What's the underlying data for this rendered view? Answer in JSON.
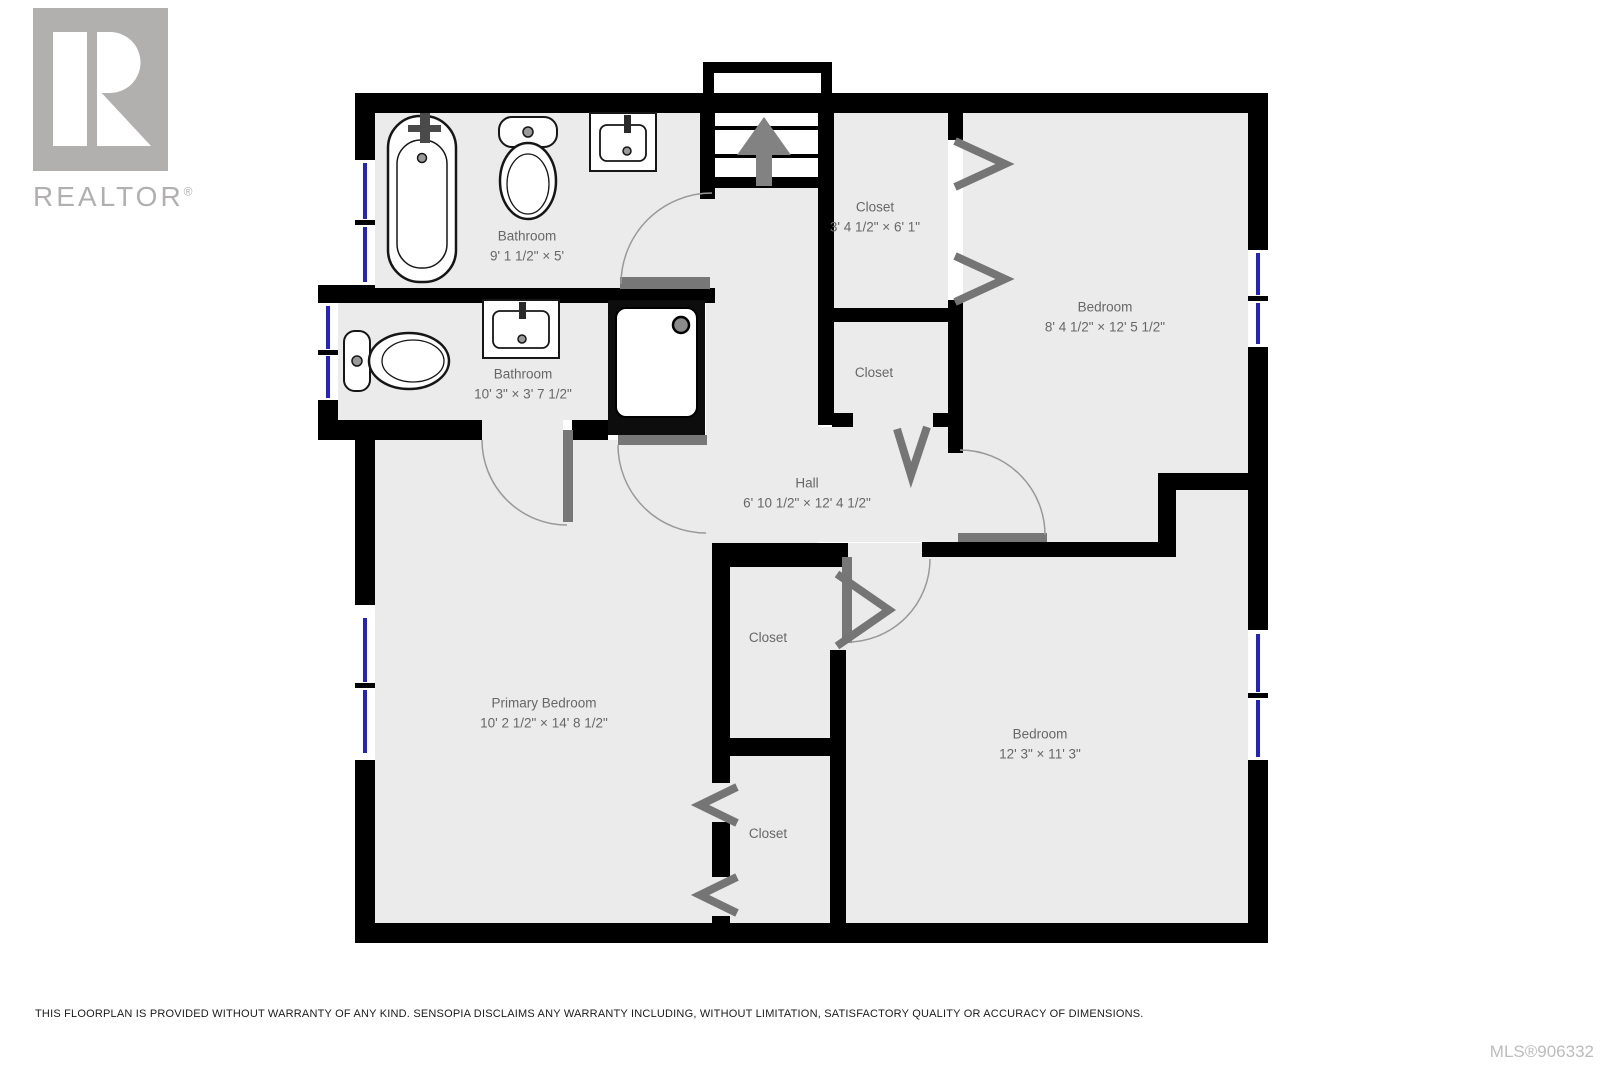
{
  "branding": {
    "logo_text": "REALTOR",
    "registered_mark": "®"
  },
  "rooms": [
    {
      "id": "bathroom-1",
      "name": "Bathroom",
      "dims": "9' 1 1/2\" × 5'"
    },
    {
      "id": "bathroom-2",
      "name": "Bathroom",
      "dims": "10' 3\" × 3' 7 1/2\""
    },
    {
      "id": "closet-1",
      "name": "Closet",
      "dims": "3' 4 1/2\" × 6' 1\""
    },
    {
      "id": "bedroom-1",
      "name": "Bedroom",
      "dims": "8' 4 1/2\" × 12' 5 1/2\""
    },
    {
      "id": "closet-2",
      "name": "Closet",
      "dims": ""
    },
    {
      "id": "hall",
      "name": "Hall",
      "dims": "6' 10 1/2\" × 12' 4 1/2\""
    },
    {
      "id": "primary-bedroom",
      "name": "Primary Bedroom",
      "dims": "10' 2 1/2\" × 14' 8 1/2\""
    },
    {
      "id": "closet-3",
      "name": "Closet",
      "dims": ""
    },
    {
      "id": "bedroom-2",
      "name": "Bedroom",
      "dims": "12' 3\" × 11' 3\""
    },
    {
      "id": "closet-4",
      "name": "Closet",
      "dims": ""
    }
  ],
  "footer": {
    "disclaimer": "THIS FLOORPLAN IS PROVIDED WITHOUT WARRANTY OF ANY KIND. SENSOPIA DISCLAIMS ANY WARRANTY INCLUDING, WITHOUT LIMITATION, SATISFACTORY QUALITY OR ACCURACY OF DIMENSIONS.",
    "mls": "MLS®906332"
  },
  "colors": {
    "wall": "#000000",
    "room_fill": "#ebebeb",
    "door": "#777777",
    "arc": "#999999",
    "window_blue": "#2323c4",
    "label": "#676767",
    "logo_gray": "#b2afaf"
  }
}
